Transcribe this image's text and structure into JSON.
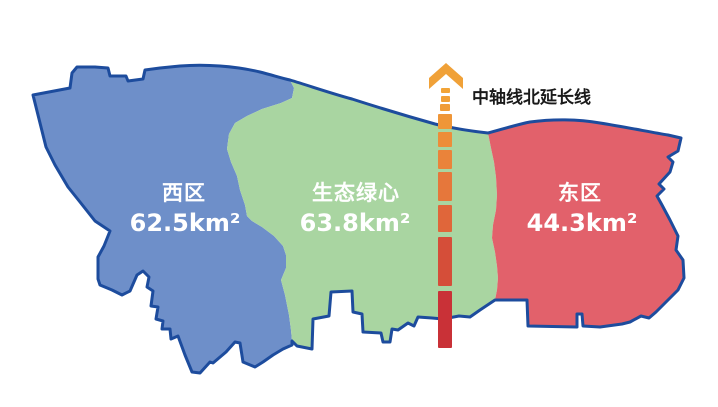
{
  "map": {
    "background": "#FFFFFF",
    "border_color": "#1D4C9D"
  },
  "regions": [
    {
      "name": "西区",
      "area": "62.5km²",
      "fill": "#6E8FC9",
      "label_color": "#FFFFFF"
    },
    {
      "name": "生态绿心",
      "area": "63.8km²",
      "fill": "#A9D5A1",
      "label_color": "#FFFFFF"
    },
    {
      "name": "东区",
      "area": "44.3km²",
      "fill": "#E2616B",
      "label_color": "#FFFFFF"
    }
  ],
  "axis": {
    "label": "中轴线北延长线",
    "label_color": "#1A1A1A",
    "arrow_color": "#F0A138",
    "dash_colors": [
      "#F2A437",
      "#F1A037",
      "#F09C38",
      "#EF9638",
      "#ED8D39",
      "#EA833A",
      "#E6773B",
      "#E0663A",
      "#D54E39",
      "#C93137"
    ]
  }
}
